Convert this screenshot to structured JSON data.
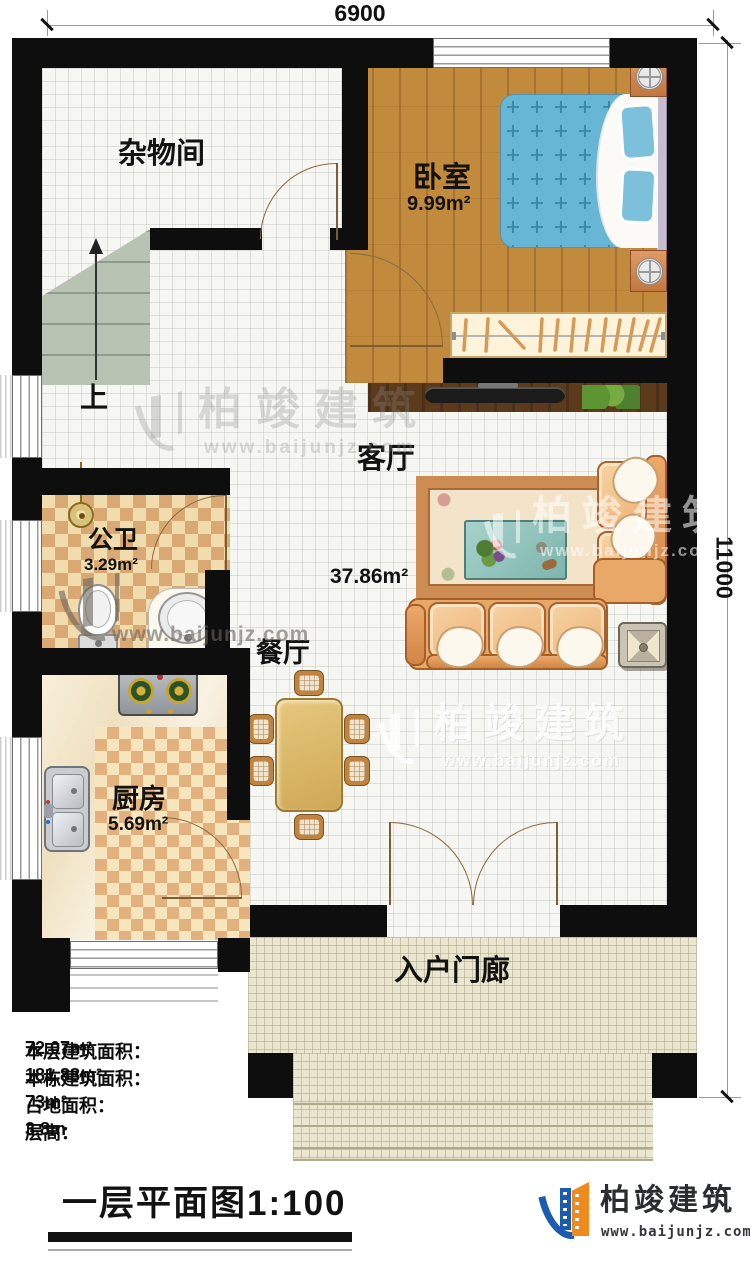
{
  "dimensions": {
    "width_label": "6900",
    "height_label": "11000"
  },
  "rooms": {
    "storage": {
      "name": "杂物间"
    },
    "bedroom": {
      "name": "卧室",
      "area": "9.99m²"
    },
    "living": {
      "name": "客厅",
      "area": "37.86m²"
    },
    "bathroom": {
      "name": "公卫",
      "area": "3.29m²"
    },
    "dining": {
      "name": "餐厅"
    },
    "kitchen": {
      "name": "厨房",
      "area": "5.69m²"
    },
    "porch": {
      "name": "入户门廊"
    },
    "stairs": {
      "up_label": "上"
    }
  },
  "stats": {
    "rows": [
      {
        "label": "本层建筑面积：",
        "value": "72.07m²"
      },
      {
        "label": "本栋建筑面积：",
        "value": "181.88m²"
      },
      {
        "label": "占地面积：",
        "value": "73m²"
      },
      {
        "label": "层高：",
        "value": "3.8m"
      }
    ]
  },
  "footer": {
    "title": "一层平面图1:100"
  },
  "branding": {
    "name": "柏竣建筑",
    "site": "www.baijunjz.com"
  },
  "watermark": {
    "name": "柏竣建筑",
    "site": "www.baijunjz.com"
  },
  "colors": {
    "wall": "#0e0e0e",
    "wood": "#c18a3c",
    "checker_dark": "#d9a873",
    "checker_light": "#f1dcae",
    "sofa": "#e8a868",
    "bed_blue": "#68b6d6",
    "logo_blue": "#1b5cb0",
    "logo_orange": "#f08a1d"
  }
}
